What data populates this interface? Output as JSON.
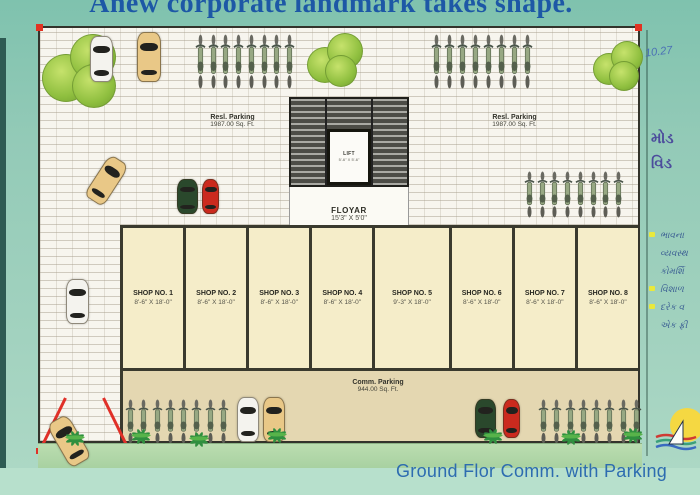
{
  "title": "Anew corporate landmark takes shape.",
  "caption": "Ground Flor Comm. with Parking",
  "plan": {
    "resi_parking_left": {
      "label": "Resl. Parking",
      "area": "1987.00 Sq. Ft."
    },
    "resi_parking_right": {
      "label": "Resl. Parking",
      "area": "1987.00 Sq. Ft."
    },
    "stairs": {
      "lift_label": "LIFT",
      "lift_dims": "5'-6\" X 5'-6\""
    },
    "floyar": {
      "label": "FLOYAR",
      "dims": "15'3\" X 5'0\""
    },
    "comm_parking": {
      "label": "Comm. Parking",
      "area": "944.00 Sq. Ft."
    },
    "shops": [
      {
        "name": "SHOP NO. 1",
        "dims": "8'-6\" X 18'-0\""
      },
      {
        "name": "SHOP NO. 2",
        "dims": "8'-6\" X 18'-0\""
      },
      {
        "name": "SHOP NO. 3",
        "dims": "8'-6\" X 18'-0\""
      },
      {
        "name": "SHOP NO. 4",
        "dims": "8'-6\" X 18'-0\""
      },
      {
        "name": "SHOP NO. 5",
        "dims": "9'-3\" X 18'-0\""
      },
      {
        "name": "SHOP NO. 6",
        "dims": "8'-6\" X 18'-0\""
      },
      {
        "name": "SHOP NO. 7",
        "dims": "8'-6\" X 18'-0\""
      },
      {
        "name": "SHOP NO. 8",
        "dims": "8'-6\" X 18'-0\""
      }
    ]
  },
  "side_notes": {
    "handwritten": "10.27",
    "heading_line1": "મોડ",
    "heading_line2": "વિડ",
    "bullets": [
      {
        "text": "ભાવના"
      },
      {
        "text": "વ્યવસ્થ"
      },
      {
        "text": "કોમર્શિ"
      },
      {
        "text": "વિશાળ"
      },
      {
        "text": "દરેક વ"
      },
      {
        "text": "એક ફ્રી"
      }
    ]
  },
  "scene": {
    "bikes_per_row": 8
  },
  "colors": {
    "accent_red": "#e23222",
    "title_blue": "#1d58a6",
    "caption_blue": "#2d6cb0",
    "shop_cream": "#f5edc9",
    "comm_tan": "#e4d7b1",
    "grass_green": "#b4d9a9"
  }
}
